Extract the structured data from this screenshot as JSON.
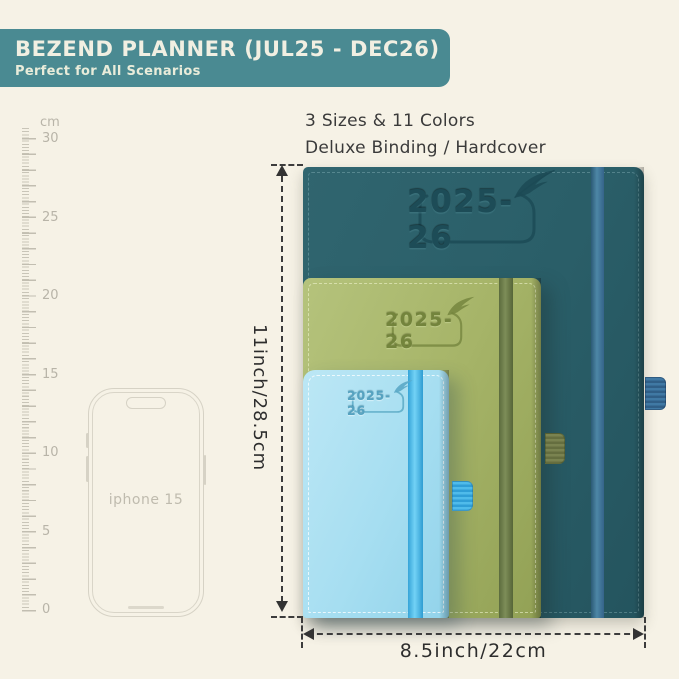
{
  "header": {
    "title": "BEZEND PLANNER (JUL25 - DEC26)",
    "subtitle": "Perfect for All Scenarios",
    "bg_color": "#4a8a92",
    "text_color": "#f1efe2"
  },
  "intro": {
    "line1": "3 Sizes & 11 Colors",
    "line2": "Deluxe Binding / Hardcover"
  },
  "ruler": {
    "unit": "cm",
    "tick_labels": [
      "30",
      "25",
      "20",
      "15",
      "10",
      "5",
      "0"
    ]
  },
  "phone": {
    "label": "iphone 15"
  },
  "planners": [
    {
      "size": "large",
      "year_label": "2025-26",
      "cover_color": "#2a5e68",
      "band_color": "#4d87a6"
    },
    {
      "size": "medium",
      "year_label": "2025-26",
      "cover_color": "#a6b468",
      "band_color": "#6f7f4b"
    },
    {
      "size": "small",
      "year_label": "2025-26",
      "cover_color": "#a6def1",
      "band_color": "#55bee9"
    }
  ],
  "dimensions": {
    "height_label": "11inch/28.5cm",
    "width_label": "8.5inch/22cm"
  },
  "background_color": "#f6f2e6"
}
